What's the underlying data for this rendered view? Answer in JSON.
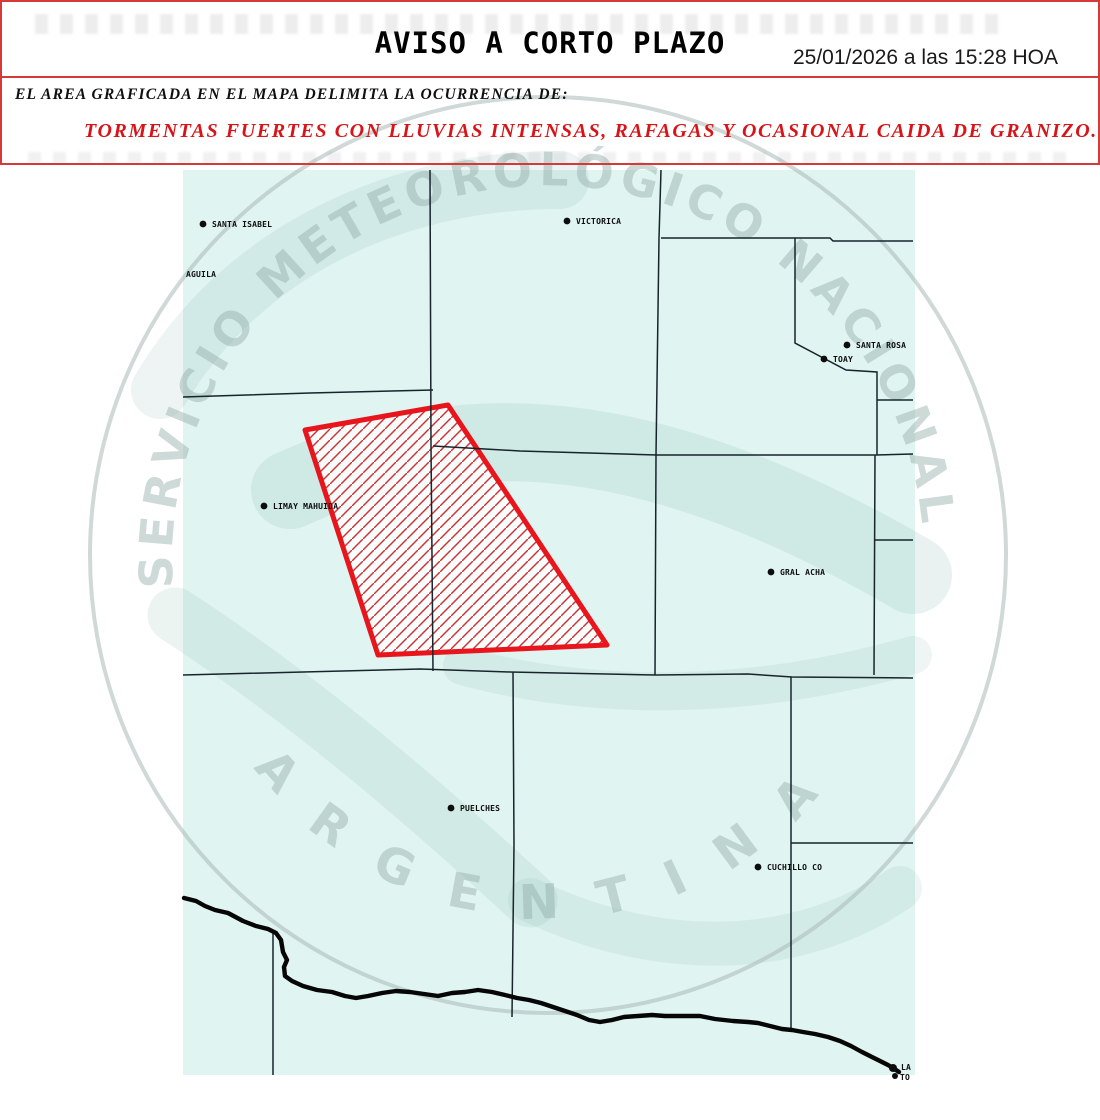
{
  "header": {
    "title": "AVISO A CORTO PLAZO",
    "timestamp": "25/01/2026 a las 15:28 HOA"
  },
  "notice": {
    "intro": "EL AREA GRAFICADA EN EL MAPA DELIMITA LA OCURRENCIA DE:",
    "warning": "TORMENTAS FUERTES CON LLUVIAS INTENSAS, RAFAGAS Y OCASIONAL CAIDA DE GRANIZO."
  },
  "watermark": {
    "arc_top": "SERVICIO METEOROLÓGICO NACIONAL",
    "arc_bottom": "ARGENTINA"
  },
  "colors": {
    "alert_text_red": "#d81418",
    "border_red": "#d43a3a",
    "map_background": "#e0f4f1",
    "boundary_line": "#17242c",
    "river_black": "#060606",
    "polygon_red": "#e8151c",
    "watermark_gray": "#9db6b2"
  },
  "map": {
    "warning_polygon": {
      "points": "305,430 448,405 607,645 378,655"
    },
    "river": {
      "d": "M 184 898 L 196 901 L 205 906 L 215 910 L 228 913 L 243 921 L 256 926 L 268 929 L 276 933 L 281 940 L 283 952 L 287 960 L 284 967 L 285 976 L 292 981 L 303 986 L 317 990 L 332 992 L 345 996 L 356 998 L 368 996 L 382 993 L 396 991 L 410 992 L 424 994 L 438 996 L 452 993 L 465 992 L 478 990 L 492 992 L 505 995 L 517 998 L 529 1000 L 541 1003 L 553 1007 L 565 1011 L 577 1015 L 589 1020 L 600 1022 L 612 1020 L 624 1017 L 638 1016 L 652 1015 L 665 1016 L 680 1016 L 700 1016 L 715 1019 L 733 1021 L 748 1022 L 758 1023 L 770 1026 L 782 1029 L 792 1030 L 803 1032 L 815 1034 L 828 1037 L 840 1041 L 851 1046 L 862 1052 L 872 1057 L 880 1061 L 888 1065 L 893 1068 L 899 1072"
    },
    "boundaries": {
      "b1": "M 430 170 L 431 445 L 433 671",
      "b2": "M 183 397 L 310 393 L 433 390",
      "b3": "M 433 446 L 520 451 L 657 455 L 876 455 L 913 454",
      "b4": "M 661 170 L 659 238 L 656 455 L 655 675",
      "b5": "M 661 238 L 830 238 L 833 241 L 913 241",
      "b6": "M 795 238 L 795 343 L 846 370 L 877 372 L 877 455 M 877 400 L 913 400",
      "b7": "M 875 455 L 874 675 M 875 540 L 913 540",
      "b8": "M 183 675 L 420 669 L 510 672 L 656 675 L 748 674 L 792 677 L 913 678",
      "b9": "M 791 677 L 791 1028 M 791 843 L 913 843",
      "b10": "M 513 672 L 514 845 L 512 1017",
      "b11": "M 273 932 L 273 1075"
    },
    "cities": {
      "santa_isabel": {
        "label": "SANTA ISABEL"
      },
      "aguila": {
        "label": "AGUILA"
      },
      "victorica": {
        "label": "VICTORICA"
      },
      "santa_rosa": {
        "label": "SANTA ROSA"
      },
      "toay": {
        "label": "TOAY"
      },
      "limay_mahuida": {
        "label": "LIMAY MAHUIDA"
      },
      "gral_acha": {
        "label": "GRAL ACHA"
      },
      "puelches": {
        "label": "PUELCHES"
      },
      "cuchillo_co": {
        "label": "CUCHILLO CO"
      },
      "la": {
        "label": "LA"
      },
      "to": {
        "label": "TO"
      }
    }
  }
}
